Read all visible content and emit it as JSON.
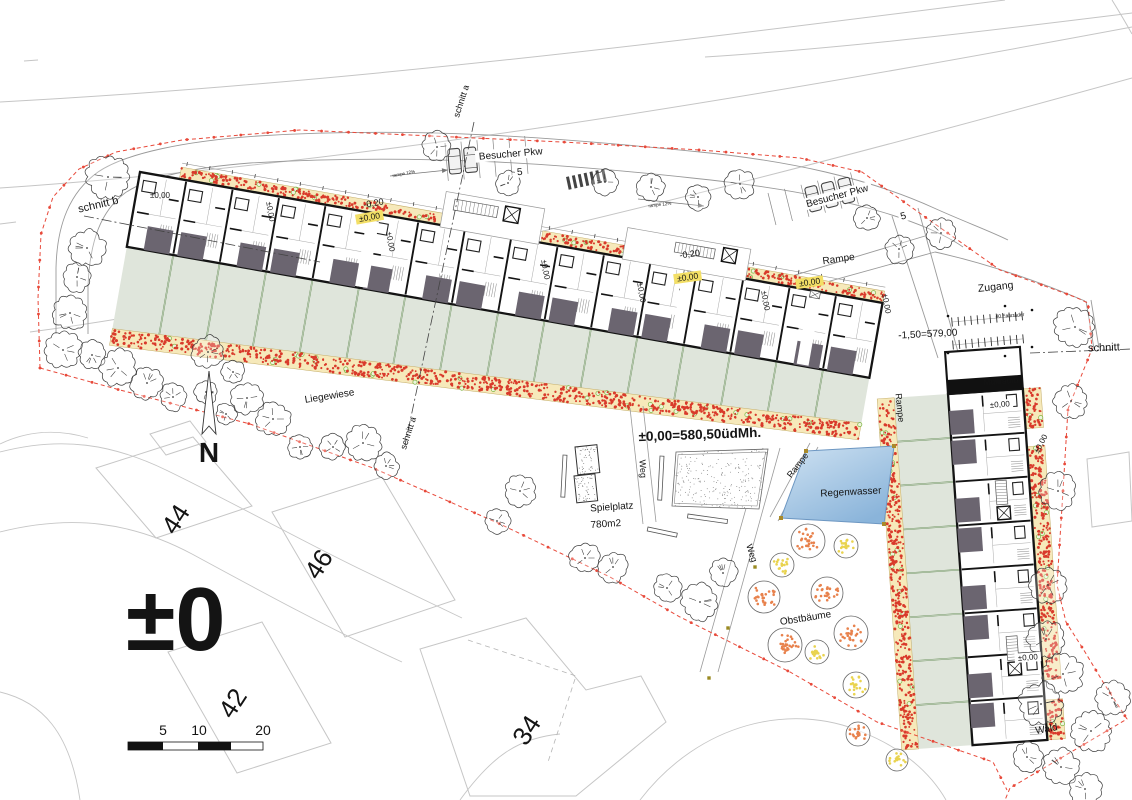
{
  "canvas": {
    "w": 1132,
    "h": 800,
    "bg": "#ffffff"
  },
  "palette": {
    "wall": "#141414",
    "patio": "#6b6570",
    "garden": "#dfe5db",
    "gardenLine": "#6f9460",
    "bed": "#f6e9ba",
    "bedEdge": "#c2ab66",
    "flowerRed": "#d93a2b",
    "flowerGreen": "#7ab33e",
    "boundary": "#e8493a",
    "contour": "#c5c5c5",
    "neighbor": "#c6c6c6",
    "road": "#9a9a9a",
    "water1": "#cfe2f2",
    "water2": "#8ab4da",
    "waterEdge": "#6d97c2",
    "fruitOrange": "#e8824d",
    "fruitYellow": "#e9d34f",
    "grayText": "#9b9b9b",
    "treeLine": "#3a3a3a",
    "detail": "#9a9a9a"
  },
  "contours": [
    "M0,102 C340,84 690,40 1005,0",
    "M705,57 C860,47 1010,28 1132,13",
    "M0,188 C350,164 720,104 1132,27",
    "M30,332 C300,296 700,198 1132,78",
    "M0,224 L16,222",
    "M24,61 L38,60",
    "M1112,0 C1120,13 1127,25 1132,34"
  ],
  "boundary": {
    "dash": "4 3",
    "dot_step": 27,
    "paths": [
      "M40,368 L38,298 L41,234 L53,197 L79,169 L116,152 L182,140 L300,130 L432,136 L562,142 L700,150 L800,158 L862,172 L935,224 L1000,270 L1042,285 L1075,297 L1088,303 L1092,349 L1068,409 L1063,491 L1057,585 L1066,622 L1085,652 L1103,682 L1127,719 L1010,788 L1005,800",
      "M40,368 L120,390 L250,424 L373,468 L500,524 L610,577 L680,617 L790,672 L877,722 L993,762 L1007,790"
    ]
  },
  "roads": {
    "edges": [
      "M258,136 C420,126 560,138 700,152 C790,161 868,178 934,208 C965,222 990,231 1008,240",
      "M250,163 C420,153 562,164 692,178 C770,186 832,197 882,212 C916,222 946,235 963,247",
      "M258,136 C186,141 126,153 98,172 C70,192 57,224 56,268 L56,334",
      "M250,163 C196,167 148,177 125,193 C101,211 90,240 88,286 L88,334",
      "M935,252 C985,263 1035,280 1085,301",
      "M1086,301 L1094,349",
      "M1091,300 L1099,348",
      "M892,216 L938,358",
      "M918,208 L958,352",
      "M752,288 L925,236",
      "M758,301 L935,252"
    ],
    "parking": [
      {
        "x": 445,
        "y": 143,
        "rot": -5,
        "n": 6,
        "gap": 16,
        "len": 38,
        "cars": [
          0,
          1
        ]
      },
      {
        "x": 768,
        "y": 193,
        "rot": -14,
        "n": 6,
        "gap": 17,
        "len": 33,
        "cars": [
          2,
          3,
          4
        ]
      }
    ],
    "zebra": {
      "x": 566,
      "y": 177,
      "rot": -12,
      "n": 7,
      "dx": 6,
      "bw": 3,
      "bh": 13
    },
    "arrows": [
      [
        390,
        176,
        448,
        170
      ],
      [
        638,
        199,
        704,
        206
      ]
    ]
  },
  "neighborhood": {
    "streets": [
      "M0,452 C62,436 112,444 166,470 C232,502 300,540 362,570 L462,618",
      "M0,532 C72,514 132,522 192,554 C262,592 332,630 402,662",
      "M88,438 C55,428 25,432 0,444",
      "M640,800 C700,722 792,702 862,732 C902,748 930,772 946,800",
      "M460,800 C492,756 518,738 560,734",
      "M0,692 C42,702 70,732 80,800"
    ],
    "houses": [
      {
        "pts": [
          [
            96,
            468
          ],
          [
            193,
            437
          ],
          [
            252,
            506
          ],
          [
            156,
            538
          ]
        ],
        "num": "44",
        "nx": 183,
        "ny": 524
      },
      {
        "pts": [
          [
            150,
            434
          ],
          [
            190,
            421
          ],
          [
            206,
            442
          ],
          [
            166,
            455
          ]
        ]
      },
      {
        "pts": [
          [
            272,
            512
          ],
          [
            382,
            477
          ],
          [
            455,
            600
          ],
          [
            345,
            637
          ]
        ],
        "num": "46",
        "nx": 326,
        "ny": 569
      },
      {
        "pts": [
          [
            168,
            652
          ],
          [
            262,
            622
          ],
          [
            331,
            743
          ],
          [
            237,
            773
          ]
        ],
        "num": "42",
        "nx": 240,
        "ny": 708
      },
      {
        "pts": [
          [
            420,
            649
          ],
          [
            526,
            618
          ],
          [
            586,
            690
          ],
          [
            641,
            676
          ],
          [
            666,
            722
          ],
          [
            576,
            796
          ],
          [
            470,
            796
          ]
        ],
        "num": "34",
        "nx": 534,
        "ny": 735
      },
      {
        "pts": [
          [
            1087,
            459
          ],
          [
            1129,
            452
          ],
          [
            1132,
            521
          ],
          [
            1092,
            527
          ]
        ]
      }
    ],
    "dashed_plot": [
      [
        468,
        640
      ],
      [
        576,
        676
      ],
      [
        548,
        762
      ]
    ]
  },
  "row1": {
    "o": [
      140,
      172
    ],
    "angle": 10,
    "len": 754,
    "depth": 76,
    "units": 16,
    "garden_y": [
      76,
      159,
      122
    ],
    "bed_h": 17,
    "top_bed": [
      [
        40,
        315
      ],
      [
        407,
        490
      ],
      [
        615,
        754
      ]
    ],
    "passages": [
      232,
      552,
      680
    ],
    "courtyards": [
      {
        "x": 305,
        "w": 100,
        "d": 34,
        "stair": [
          315,
          -28,
          44,
          11
        ],
        "elev": [
          366,
          -30,
          15,
          15
        ]
      },
      {
        "x": 490,
        "w": 125,
        "d": 30,
        "stair": [
          540,
          -24,
          40,
          10
        ],
        "elev": [
          588,
          -27,
          14,
          14
        ]
      }
    ]
  },
  "row2": {
    "o": [
      948,
      394
    ],
    "angle": 86,
    "len": 352,
    "depth": 75,
    "units": 8,
    "garden_d": 54,
    "bed_h": 17,
    "east_bed": [
      [
        0,
        40
      ],
      [
        58,
        292
      ],
      [
        312,
        352
      ]
    ],
    "muell": {
      "x0": -42,
      "bar": 14
    },
    "stair_units": [
      90,
      246
    ]
  },
  "trees": [
    [
      437,
      147,
      14
    ],
    [
      508,
      183,
      12
    ],
    [
      605,
      182,
      12
    ],
    [
      651,
      187,
      13
    ],
    [
      698,
      197,
      12
    ],
    [
      740,
      184,
      14
    ],
    [
      867,
      218,
      12
    ],
    [
      899,
      249,
      13
    ],
    [
      941,
      233,
      15
    ],
    [
      1075,
      327,
      19
    ],
    [
      1071,
      401,
      16
    ],
    [
      1058,
      491,
      17
    ],
    [
      1048,
      585,
      17
    ],
    [
      108,
      177,
      20
    ],
    [
      87,
      248,
      17
    ],
    [
      77,
      277,
      14
    ],
    [
      70,
      313,
      16
    ],
    [
      63,
      350,
      17
    ],
    [
      92,
      355,
      13
    ],
    [
      118,
      368,
      17
    ],
    [
      147,
      383,
      15
    ],
    [
      173,
      397,
      13
    ],
    [
      208,
      352,
      15
    ],
    [
      233,
      372,
      11
    ],
    [
      206,
      392,
      11
    ],
    [
      247,
      398,
      15
    ],
    [
      226,
      414,
      10
    ],
    [
      273,
      419,
      16
    ],
    [
      300,
      447,
      12
    ],
    [
      333,
      447,
      12
    ],
    [
      363,
      443,
      17
    ],
    [
      386,
      466,
      12
    ],
    [
      520,
      491,
      15
    ],
    [
      497,
      521,
      12
    ],
    [
      585,
      558,
      14
    ],
    [
      613,
      567,
      14
    ],
    [
      667,
      588,
      13
    ],
    [
      700,
      602,
      17
    ],
    [
      723,
      573,
      13
    ],
    [
      1046,
      639,
      17
    ],
    [
      1063,
      674,
      19
    ],
    [
      1041,
      704,
      20
    ],
    [
      1091,
      731,
      19
    ],
    [
      1027,
      757,
      14
    ],
    [
      1061,
      767,
      17
    ],
    [
      1112,
      698,
      16
    ],
    [
      1085,
      789,
      15
    ]
  ],
  "fruit_trees": [
    [
      808,
      541,
      17,
      "o"
    ],
    [
      846,
      546,
      12,
      "y"
    ],
    [
      782,
      565,
      12,
      "y"
    ],
    [
      764,
      597,
      16,
      "o"
    ],
    [
      827,
      593,
      16,
      "o"
    ],
    [
      851,
      633,
      17,
      "o"
    ],
    [
      785,
      645,
      17,
      "o"
    ],
    [
      817,
      652,
      12,
      "y"
    ],
    [
      856,
      685,
      13,
      "y"
    ],
    [
      858,
      734,
      12,
      "o"
    ],
    [
      897,
      760,
      11,
      "y"
    ]
  ],
  "pond": {
    "pts": [
      [
        806,
        451
      ],
      [
        894,
        446
      ],
      [
        884,
        524
      ],
      [
        781,
        518
      ]
    ]
  },
  "playground": {
    "sandboxes": [
      [
        575,
        447,
        22,
        28,
        -6
      ],
      [
        574,
        476,
        21,
        27,
        -6
      ]
    ],
    "benches": [
      [
        563,
        455,
        4,
        42,
        3
      ],
      [
        660,
        456,
        4,
        44,
        3
      ],
      [
        648,
        527,
        30,
        4,
        12
      ],
      [
        688,
        514,
        40,
        4,
        8
      ]
    ],
    "plaza": [
      [
        676,
        452
      ],
      [
        768,
        449
      ],
      [
        759,
        509
      ],
      [
        672,
        506
      ]
    ]
  },
  "paths_walk": {
    "weg_v": [
      [
        630,
        408,
        643,
        524
      ],
      [
        643,
        406,
        656,
        522
      ]
    ],
    "weg_d": [
      [
        763,
        448,
        700,
        672
      ],
      [
        780,
        448,
        718,
        672
      ]
    ],
    "ramp_d": [
      [
        770,
        517,
        810,
        443
      ],
      [
        778,
        521,
        818,
        447
      ]
    ],
    "ticks": [
      [
        755,
        567
      ],
      [
        728,
        628
      ],
      [
        709,
        678
      ]
    ]
  },
  "bike_racks": {
    "rows": [
      [
        952,
        322
      ],
      [
        953,
        345
      ]
    ],
    "n": 12,
    "dx": 6.4,
    "tick": 9,
    "rot": -5,
    "dots": [
      [
        948,
        316
      ],
      [
        1032,
        310
      ],
      [
        948,
        353
      ],
      [
        1032,
        347
      ],
      [
        1005,
        306
      ],
      [
        1005,
        356
      ]
    ]
  },
  "sections": [
    {
      "d": "M474,122 L405,445"
    },
    {
      "d": "M84,216 L320,262"
    },
    {
      "d": "M1030,353 L1132,349"
    }
  ],
  "north": {
    "x": 209,
    "y1": 371,
    "y2": 434,
    "label": "N",
    "ly": 462,
    "ls": 28
  },
  "scalebar": {
    "x": 128,
    "y": 742,
    "h": 8,
    "labels": [
      [
        "5",
        163
      ],
      [
        "10",
        199
      ],
      [
        "20",
        263
      ]
    ],
    "ly": 735
  },
  "big_marker": {
    "text": "±0",
    "x": 126,
    "y": 650,
    "size": 90
  },
  "labels": [
    {
      "id": "schnitt-a-top",
      "t": "schnitt a",
      "x": 464,
      "y": 102,
      "r": -72,
      "s": 9
    },
    {
      "id": "schnitt-a-mid",
      "t": "schnitt a",
      "x": 411,
      "y": 434,
      "r": -72,
      "s": 9
    },
    {
      "id": "schnitt-b",
      "t": "schnitt b",
      "x": 99,
      "y": 208,
      "r": -13,
      "s": 11
    },
    {
      "id": "schnitt-right",
      "t": "schnitt",
      "x": 1104,
      "y": 351,
      "r": -2,
      "s": 11
    },
    {
      "id": "besucher-pkw-1",
      "t": "Besucher Pkw",
      "x": 511,
      "y": 157,
      "r": -5,
      "s": 10,
      "bg": "#ffffff"
    },
    {
      "id": "pkw-1-count",
      "t": "5",
      "x": 520,
      "y": 175,
      "r": -5,
      "s": 10,
      "bg": "#ffffff"
    },
    {
      "id": "besucher-pkw-2",
      "t": "Besucher Pkw",
      "x": 838,
      "y": 199,
      "r": -15,
      "s": 10,
      "bg": "#ffffff"
    },
    {
      "id": "pkw-2-count",
      "t": "5",
      "x": 904,
      "y": 219,
      "r": -15,
      "s": 10,
      "bg": "#ffffff"
    },
    {
      "id": "rampe-12-left",
      "t": "rampe 12%",
      "x": 404,
      "y": 175,
      "r": -11,
      "s": 4.5,
      "c": "#444444"
    },
    {
      "id": "rampe-12-right",
      "t": "rampe 12%",
      "x": 660,
      "y": 206,
      "r": -7,
      "s": 4.5,
      "c": "#444444"
    },
    {
      "id": "level-020-a",
      "t": "-0,20",
      "x": 374,
      "y": 206,
      "r": -10,
      "s": 9
    },
    {
      "id": "level-000-a",
      "t": "±0,00",
      "x": 370,
      "y": 220,
      "r": -10,
      "s": 8.5,
      "bg": "#f3df66"
    },
    {
      "id": "level-020-b",
      "t": "-0,20",
      "x": 690,
      "y": 257,
      "r": -8,
      "s": 9
    },
    {
      "id": "level-000-b",
      "t": "±0,00",
      "x": 688,
      "y": 280,
      "r": -8,
      "s": 8.5,
      "bg": "#f3df66"
    },
    {
      "id": "level-000-c",
      "t": "±0,00",
      "x": 810,
      "y": 285,
      "r": -8,
      "s": 8.5,
      "bg": "#f3df66"
    },
    {
      "id": "rampe-top",
      "t": "Rampe",
      "x": 839,
      "y": 262,
      "r": -8,
      "s": 10
    },
    {
      "id": "zugang",
      "t": "Zugang",
      "x": 996,
      "y": 290,
      "r": -6,
      "s": 10.5
    },
    {
      "id": "fahrraeder",
      "t": "40 Fahrräder",
      "x": 1010,
      "y": 317,
      "r": -4,
      "s": 5,
      "c": "#333333"
    },
    {
      "id": "level-150-579",
      "t": "-1,50=579,00",
      "x": 928,
      "y": 337,
      "r": -3,
      "s": 10
    },
    {
      "id": "level-000-row1-left",
      "t": "±0,00",
      "x": 160,
      "y": 198,
      "r": 0,
      "s": 8
    },
    {
      "id": "level-000-v1",
      "t": "±0,00",
      "x": 268,
      "y": 212,
      "r": 80,
      "s": 8
    },
    {
      "id": "level-000-v2",
      "t": "±0,00",
      "x": 388,
      "y": 242,
      "r": 80,
      "s": 8
    },
    {
      "id": "level-000-v3",
      "t": "±0,00",
      "x": 543,
      "y": 270,
      "r": 80,
      "s": 8
    },
    {
      "id": "level-000-v4",
      "t": "±0,00",
      "x": 639,
      "y": 293,
      "r": 80,
      "s": 8
    },
    {
      "id": "level-000-v5",
      "t": "±0,00",
      "x": 763,
      "y": 301,
      "r": 80,
      "s": 8
    },
    {
      "id": "level-000-v6",
      "t": "±0,00",
      "x": 884,
      "y": 304,
      "r": 80,
      "s": 8
    },
    {
      "id": "liegewiese",
      "t": "Liegewiese",
      "x": 330,
      "y": 399,
      "r": -9,
      "s": 10
    },
    {
      "id": "main-level",
      "t": "±0,00=580,50üdMh.",
      "x": 700,
      "y": 439,
      "r": -2,
      "s": 13.5,
      "w": "b"
    },
    {
      "id": "spielplatz",
      "t": "Spielplatz",
      "x": 612,
      "y": 510,
      "r": -4,
      "s": 10
    },
    {
      "id": "spielplatz-area",
      "t": "780m2",
      "x": 606,
      "y": 527,
      "r": -4,
      "s": 10
    },
    {
      "id": "weg-vertical",
      "t": "Weg",
      "x": 640,
      "y": 469,
      "r": 86,
      "s": 9
    },
    {
      "id": "weg-diagonal",
      "t": "Weg",
      "x": 749,
      "y": 554,
      "r": 72,
      "s": 9
    },
    {
      "id": "rampe-diagonal",
      "t": "Rampe",
      "x": 800,
      "y": 467,
      "r": -52,
      "s": 9
    },
    {
      "id": "rampe-vertical",
      "t": "Rampe",
      "x": 897,
      "y": 408,
      "r": 84,
      "s": 9
    },
    {
      "id": "regenwasser",
      "t": "Regenwasser",
      "x": 851,
      "y": 495,
      "r": -3,
      "s": 10
    },
    {
      "id": "obstbaeume",
      "t": "Obstbäume",
      "x": 806,
      "y": 621,
      "r": -9,
      "s": 10
    },
    {
      "id": "muellraum",
      "t": "Müllraum",
      "x": 1001,
      "y": 384,
      "r": -4,
      "s": 8.5,
      "c": "#ffffff"
    },
    {
      "id": "level-000-b2-top",
      "t": "±0,00",
      "x": 1000,
      "y": 407,
      "r": -4,
      "s": 8,
      "bg": "#ffffff"
    },
    {
      "id": "level-000-b2-right",
      "t": "±0,00",
      "x": 1043,
      "y": 445,
      "r": -62,
      "s": 8
    },
    {
      "id": "level-000-b2-bottom",
      "t": "±0,00",
      "x": 1028,
      "y": 660,
      "r": -4,
      "s": 8,
      "bg": "#ffffff"
    },
    {
      "id": "wald",
      "t": "Wald",
      "x": 1047,
      "y": 732,
      "r": -10,
      "s": 10
    },
    {
      "id": "house-44",
      "t": "44",
      "x": 183,
      "y": 524,
      "r": -57,
      "s": 26,
      "c": "#c7c7c7"
    },
    {
      "id": "house-46",
      "t": "46",
      "x": 326,
      "y": 569,
      "r": -57,
      "s": 26,
      "c": "#c7c7c7"
    },
    {
      "id": "house-42",
      "t": "42",
      "x": 240,
      "y": 708,
      "r": -57,
      "s": 26,
      "c": "#c7c7c7"
    },
    {
      "id": "house-34",
      "t": "34",
      "x": 534,
      "y": 735,
      "r": -57,
      "s": 26,
      "c": "#c7c7c7"
    }
  ]
}
